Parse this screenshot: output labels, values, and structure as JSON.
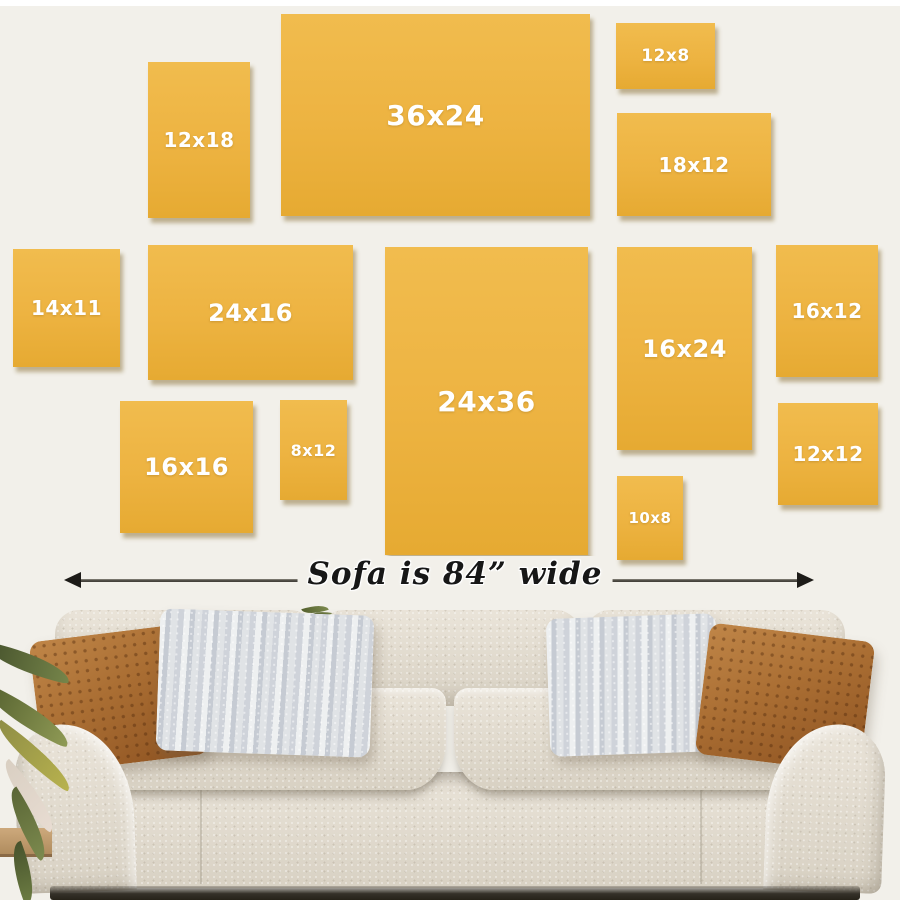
{
  "dimension_label": {
    "text": "Sofa is 84” wide"
  },
  "size_guide": {
    "canvases": [
      {
        "label": "12x18",
        "x": 148,
        "y": 62,
        "w": 102,
        "h": 156,
        "fs": 20
      },
      {
        "label": "36x24",
        "x": 281,
        "y": 14,
        "w": 309,
        "h": 202,
        "fs": 28
      },
      {
        "label": "12x8",
        "x": 616,
        "y": 23,
        "w": 99,
        "h": 66,
        "fs": 17
      },
      {
        "label": "18x12",
        "x": 617,
        "y": 113,
        "w": 154,
        "h": 103,
        "fs": 20
      },
      {
        "label": "14x11",
        "x": 13,
        "y": 249,
        "w": 107,
        "h": 118,
        "fs": 20
      },
      {
        "label": "24x16",
        "x": 148,
        "y": 245,
        "w": 205,
        "h": 135,
        "fs": 24
      },
      {
        "label": "24x36",
        "x": 385,
        "y": 247,
        "w": 203,
        "h": 308,
        "fs": 28
      },
      {
        "label": "16x24",
        "x": 617,
        "y": 247,
        "w": 135,
        "h": 203,
        "fs": 24
      },
      {
        "label": "16x12",
        "x": 776,
        "y": 245,
        "w": 102,
        "h": 132,
        "fs": 20
      },
      {
        "label": "16x16",
        "x": 120,
        "y": 401,
        "w": 133,
        "h": 132,
        "fs": 24
      },
      {
        "label": "8x12",
        "x": 280,
        "y": 400,
        "w": 67,
        "h": 100,
        "fs": 16
      },
      {
        "label": "10x8",
        "x": 617,
        "y": 476,
        "w": 66,
        "h": 84,
        "fs": 15
      },
      {
        "label": "12x12",
        "x": 778,
        "y": 403,
        "w": 100,
        "h": 102,
        "fs": 20
      }
    ]
  },
  "colors": {
    "wall": "#f2f0ea",
    "top_border": "#ffffff",
    "canvas_fill": "#edb341",
    "canvas_fill_light": "#f1bc4e",
    "canvas_fill_dark": "#e6aa32",
    "canvas_label": "#ffffff",
    "canvas_shadow": "rgba(125,95,30,0.45)",
    "arrow_line": "#45423c",
    "arrow_head": "#1d1b18",
    "caption_text": "#171717",
    "sofa_fabric": "#eae4d9",
    "sofa_fabric_dark": "#d8d1c3",
    "pillow_rust": "#aa6e33",
    "pillow_rust_dark": "#8c5120",
    "pillow_stripe_light": "#eef0f1",
    "pillow_stripe_dark": "#c6cbd3",
    "plant_leaf": "#8f9a55",
    "plant_leaf_dark": "#5a6636",
    "floor": "#cda97c",
    "under_shadow": "#353129"
  }
}
